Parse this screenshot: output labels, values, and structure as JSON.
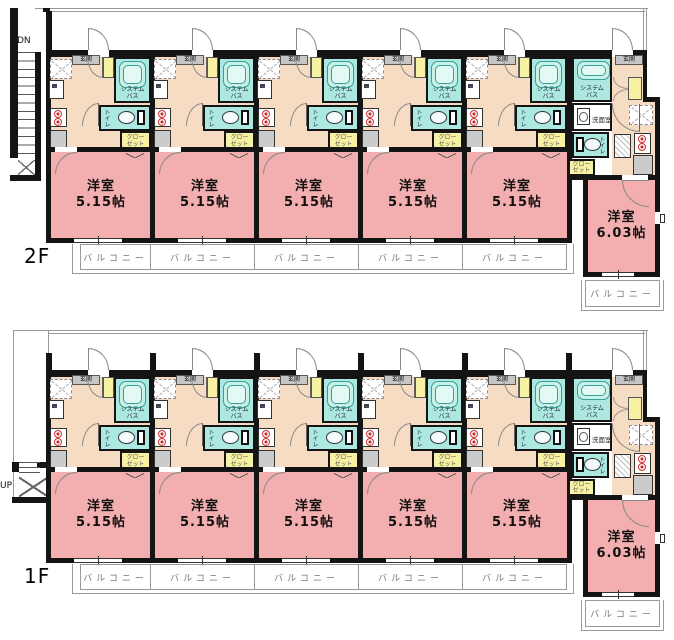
{
  "floors": [
    {
      "label": "2F",
      "stairs_label": "DN",
      "standard_unit_count": 5,
      "standard_room_size": "5.15帖",
      "large_room_size": "6.03帖"
    },
    {
      "label": "1F",
      "stairs_label": "UP",
      "standard_unit_count": 5,
      "standard_room_size": "5.15帖",
      "large_room_size": "6.03帖"
    }
  ],
  "labels": {
    "entrance": "玄関",
    "system_bath_1": "システム",
    "system_bath_2": "バス",
    "toilet": "トイレ",
    "closet_1": "クロー",
    "closet_2": "ゼット",
    "washroom": "洗面室",
    "room": "洋室",
    "balcony": "バルコニー"
  },
  "colors": {
    "wall": "#141414",
    "room_pink": "#F3AFAF",
    "kitchen_peach": "#F6DCC3",
    "bath_cyan": "#ACE8E0",
    "tub_fill": "#C9F1EA",
    "accent_yellow": "#F7F1A3",
    "label_gray": "#C6C6C6",
    "appliance_gray": "#CBCBCB",
    "line_gray": "#999999",
    "text_gray": "#777777",
    "burner_red": "#CC3333"
  }
}
